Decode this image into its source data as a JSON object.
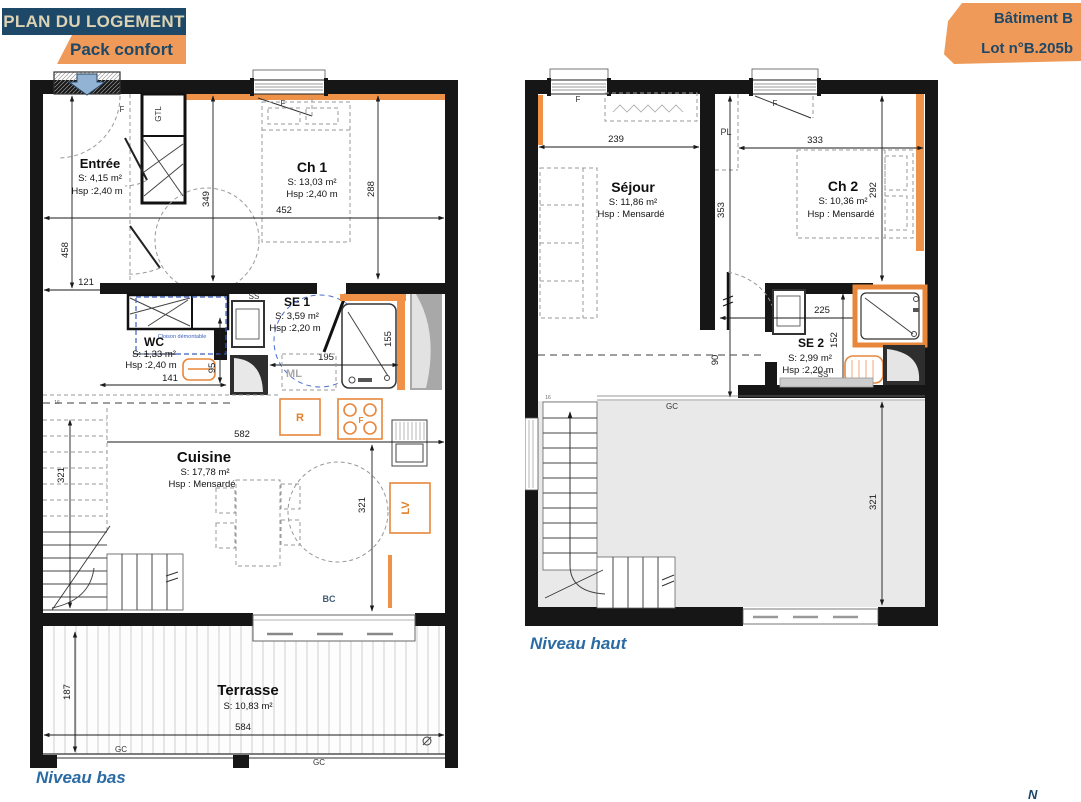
{
  "header": {
    "title": "PLAN DU LOGEMENT",
    "pack": "Pack confort"
  },
  "badge": {
    "building": "Bâtiment B",
    "lot": "Lot n°B.205b"
  },
  "compass": {
    "north": "N"
  },
  "colors": {
    "navy": "#1d4868",
    "orange": "#f09a59",
    "wall_accent": "#ef9147",
    "caption_blue": "#2b6ba4"
  },
  "plans": {
    "bas": {
      "caption": "Niveau bas",
      "rooms": {
        "entree": {
          "name": "Entrée",
          "area": "S: 4,15 m²",
          "hsp": "Hsp :2,40 m"
        },
        "ch1": {
          "name": "Ch 1",
          "area": "S: 13,03 m²",
          "hsp": "Hsp :2,40 m"
        },
        "wc": {
          "name": "WC",
          "area": "S: 1,33 m²",
          "hsp": "Hsp :2,40 m"
        },
        "se1": {
          "name": "SE 1",
          "area": "S: 3,59 m²",
          "hsp": "Hsp :2,20 m"
        },
        "cuisine": {
          "name": "Cuisine",
          "area": "S: 17,78 m²",
          "hsp": "Hsp : Mensardé"
        },
        "terrasse": {
          "name": "Terrasse",
          "area": "S: 10,83 m²"
        }
      },
      "dims": {
        "w452": "452",
        "h288": "288",
        "h349": "349",
        "h458": "458",
        "w121": "121",
        "w141": "141",
        "h95": "95",
        "w195": "195",
        "h155": "155",
        "w582": "582",
        "h321_stairs": "321",
        "h321_cuisine": "321",
        "h187": "187",
        "w584": "584",
        "steps": "16"
      },
      "labels": {
        "gtl": "GTL",
        "f_entree": "F",
        "f_ch1": "F",
        "ss": "SS",
        "cloison": "Cloison démontable",
        "ml": "ML",
        "r": "R",
        "f_four": "F",
        "lv": "LV",
        "bc": "BC",
        "gc_left": "GC",
        "gc_right": "GC"
      }
    },
    "haut": {
      "caption": "Niveau haut",
      "rooms": {
        "sejour": {
          "name": "Séjour",
          "area": "S: 11,86 m²",
          "hsp": "Hsp : Mensardé"
        },
        "ch2": {
          "name": "Ch 2",
          "area": "S: 10,36 m²",
          "hsp": "Hsp : Mensardé"
        },
        "se2": {
          "name": "SE 2",
          "area": "S: 2,99 m²",
          "hsp": "Hsp :2,20 m"
        }
      },
      "dims": {
        "w239": "239",
        "w333": "333",
        "h353": "353",
        "h292": "292",
        "w225": "225",
        "h152": "152",
        "h90": "90",
        "h321": "321",
        "steps": "16"
      },
      "labels": {
        "pl": "PL",
        "f_sejour": "F",
        "f_ch2": "F",
        "ss": "SS",
        "gc": "GC"
      }
    }
  }
}
